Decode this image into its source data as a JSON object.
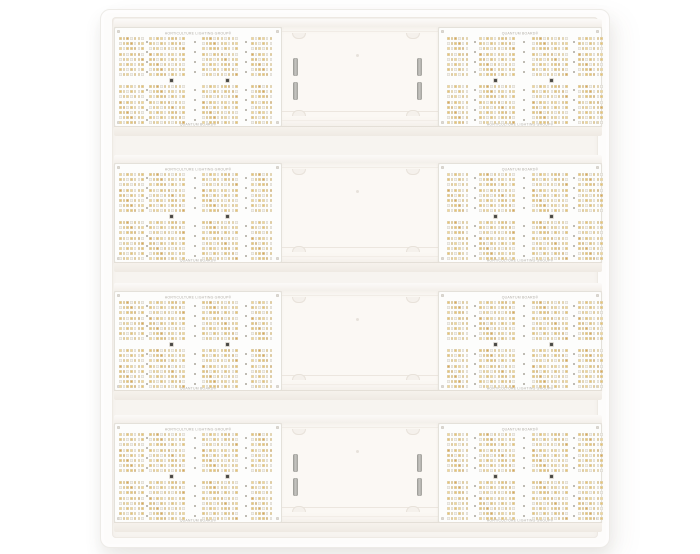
{
  "product": {
    "name": "LED quantum board grow light fixture",
    "board_labels": {
      "left_top": "HORTICULTURE LIGHTING GROUP®",
      "left_bottom": "QUANTUM BOARD®",
      "right_top": "QUANTUM BOARD®",
      "right_bottom": "HORTICULTURE LIGHTING GROUP®"
    }
  },
  "layout": {
    "fixture": {
      "left": 100,
      "top": 9,
      "width": 508,
      "height": 537
    },
    "tray": {
      "left": 11,
      "top": 7,
      "width": 486,
      "height": 521
    },
    "bar_width": 488,
    "bar_left": 13,
    "bar_height": 117,
    "bars": [
      {
        "y": 9,
        "vent_slots": true
      },
      {
        "y": 145,
        "vent_slots": false
      },
      {
        "y": 273,
        "vent_slots": false
      },
      {
        "y": 405,
        "vent_slots": true
      }
    ],
    "left_board": {
      "x": 0,
      "width": 168,
      "groups": [
        {
          "x": 4,
          "cols": 7
        },
        {
          "x": 34,
          "cols": 10
        },
        {
          "x": 87,
          "cols": 10
        },
        {
          "x": 136,
          "cols": 6
        }
      ],
      "dash_cols": [
        30.5,
        79,
        130
      ]
    },
    "right_board": {
      "x": 324,
      "width": 164,
      "groups": [
        {
          "x": 8,
          "cols": 6
        },
        {
          "x": 40,
          "cols": 10
        },
        {
          "x": 93,
          "cols": 10
        },
        {
          "x": 139,
          "cols": 7
        }
      ],
      "dash_cols": [
        34.5,
        84,
        134
      ]
    },
    "center_panel": {
      "x": 168,
      "width": 156,
      "notch_xs": [
        10,
        124
      ],
      "notch_top_y": 6,
      "notch_bottom_y": 83,
      "slot_xs": [
        11,
        135
      ],
      "slot_ys": [
        31,
        55
      ],
      "dot": {
        "x": 74,
        "y": 27
      }
    },
    "cluster": {
      "led_rows": 8,
      "pitch_x": 3.7,
      "pitch_y": 5.2,
      "row1_y": 9,
      "row2_y": 57
    },
    "screw_xs": [
      55,
      111
    ],
    "screw_y": 50.5,
    "label_top_y": 1.5,
    "label_bottom_y": 92.5
  },
  "colors": {
    "led_amber": "#eac56f",
    "led_amber_light": "#f3d893",
    "led_amber_deep": "#ddab52",
    "led_white": "#f3f1eb",
    "led_edge": "#d9d5cc",
    "pcb_white": "#fdfdfc",
    "channel_white": "#fbf8f4",
    "frame_white": "#fdfcfb",
    "slot_gray": "#aaa9a4"
  }
}
